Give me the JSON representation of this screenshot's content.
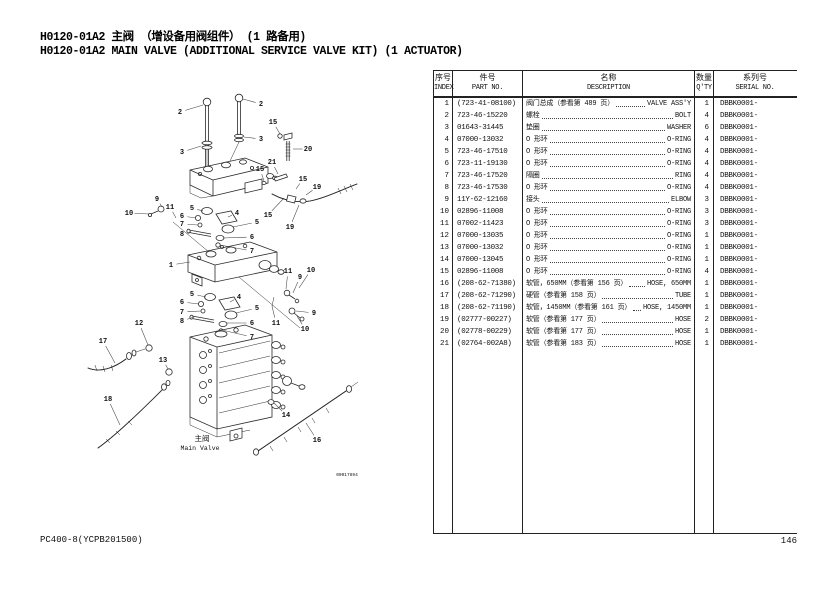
{
  "page": {
    "title_zh": "H0120-01A2 主阀 （增设备用阀组件） (1 路备用)",
    "title_en": "H0120-01A2 MAIN VALVE (ADDITIONAL SERVICE VALVE KIT) (1 ACTUATOR)",
    "footer_left": "PC400-8(YCPB201500)",
    "page_number": "146"
  },
  "diagram": {
    "drawing_number": "00017894",
    "main_valve_label_zh": "主阀",
    "main_valve_label_en": "Main Valve",
    "callouts": [
      {
        "label": "2",
        "x": 140,
        "y": 37,
        "lx": 163,
        "ly": 30
      },
      {
        "label": "2",
        "x": 221,
        "y": 29,
        "lx": 203,
        "ly": 24
      },
      {
        "label": "3",
        "x": 142,
        "y": 77,
        "lx": 161,
        "ly": 71
      },
      {
        "label": "3",
        "x": 221,
        "y": 64,
        "lx": 204,
        "ly": 62
      },
      {
        "label": "15",
        "x": 233,
        "y": 47,
        "lx": 240,
        "ly": 59
      },
      {
        "label": "20",
        "x": 268,
        "y": 74,
        "lx": 253,
        "ly": 74
      },
      {
        "label": "21",
        "x": 232,
        "y": 87,
        "lx": 238,
        "ly": 99
      },
      {
        "label": "15",
        "x": 220,
        "y": 94,
        "lx": 224,
        "ly": 106
      },
      {
        "label": "15",
        "x": 263,
        "y": 104,
        "lx": 256,
        "ly": 114
      },
      {
        "label": "19",
        "x": 277,
        "y": 112,
        "lx": 266,
        "ly": 120
      },
      {
        "label": "15",
        "x": 228,
        "y": 140,
        "lx": 244,
        "ly": 123
      },
      {
        "label": "19",
        "x": 250,
        "y": 152,
        "lx": 259,
        "ly": 130
      },
      {
        "label": "9",
        "x": 117,
        "y": 124,
        "lx": 122,
        "ly": 132
      },
      {
        "label": "10",
        "x": 89,
        "y": 138,
        "lx": 109,
        "ly": 139
      },
      {
        "label": "11",
        "x": 130,
        "y": 132,
        "lx": 136,
        "ly": 143
      },
      {
        "label": "5",
        "x": 152,
        "y": 133,
        "lx": 163,
        "ly": 136
      },
      {
        "label": "6",
        "x": 142,
        "y": 141,
        "lx": 156,
        "ly": 143
      },
      {
        "label": "7",
        "x": 142,
        "y": 149,
        "lx": 158,
        "ly": 150
      },
      {
        "label": "8",
        "x": 142,
        "y": 159,
        "lx": 151,
        "ly": 157
      },
      {
        "label": "4",
        "x": 197,
        "y": 138,
        "lx": 188,
        "ly": 142
      },
      {
        "label": "5",
        "x": 217,
        "y": 147,
        "lx": 193,
        "ly": 152
      },
      {
        "label": "6",
        "x": 212,
        "y": 162,
        "lx": 183,
        "ly": 163
      },
      {
        "label": "7",
        "x": 212,
        "y": 176,
        "lx": 180,
        "ly": 170
      },
      {
        "label": "1",
        "x": 131,
        "y": 190,
        "lx": 150,
        "ly": 187
      },
      {
        "label": "11",
        "x": 248,
        "y": 196,
        "lx": 246,
        "ly": 214
      },
      {
        "label": "9",
        "x": 260,
        "y": 202,
        "lx": 253,
        "ly": 218
      },
      {
        "label": "10",
        "x": 271,
        "y": 195,
        "lx": 259,
        "ly": 213
      },
      {
        "label": "5",
        "x": 152,
        "y": 219,
        "lx": 166,
        "ly": 222
      },
      {
        "label": "6",
        "x": 142,
        "y": 227,
        "lx": 159,
        "ly": 229
      },
      {
        "label": "7",
        "x": 142,
        "y": 237,
        "lx": 161,
        "ly": 236
      },
      {
        "label": "8",
        "x": 142,
        "y": 246,
        "lx": 154,
        "ly": 242
      },
      {
        "label": "4",
        "x": 199,
        "y": 222,
        "lx": 190,
        "ly": 227
      },
      {
        "label": "5",
        "x": 217,
        "y": 233,
        "lx": 196,
        "ly": 238
      },
      {
        "label": "6",
        "x": 212,
        "y": 248,
        "lx": 186,
        "ly": 248
      },
      {
        "label": "7",
        "x": 212,
        "y": 262,
        "lx": 182,
        "ly": 255
      },
      {
        "label": "11",
        "x": 236,
        "y": 248,
        "lx": 232,
        "ly": 231
      },
      {
        "label": "9",
        "x": 274,
        "y": 238,
        "lx": 256,
        "ly": 236
      },
      {
        "label": "10",
        "x": 265,
        "y": 254,
        "lx": 257,
        "ly": 241
      },
      {
        "label": "12",
        "x": 99,
        "y": 248,
        "lx": 108,
        "ly": 270
      },
      {
        "label": "17",
        "x": 63,
        "y": 266,
        "lx": 75,
        "ly": 288
      },
      {
        "label": "13",
        "x": 123,
        "y": 285,
        "lx": 128,
        "ly": 294
      },
      {
        "label": "18",
        "x": 68,
        "y": 324,
        "lx": 80,
        "ly": 350
      },
      {
        "label": "14",
        "x": 246,
        "y": 340,
        "lx": 234,
        "ly": 328
      },
      {
        "label": "16",
        "x": 277,
        "y": 365,
        "lx": 266,
        "ly": 348
      }
    ]
  },
  "table": {
    "headers": [
      {
        "zh": "序号",
        "en": "INDEX"
      },
      {
        "zh": "件号",
        "en": "PART NO."
      },
      {
        "zh": "名称",
        "en": "DESCRIPTION"
      },
      {
        "zh": "数量",
        "en": "Q'TY"
      },
      {
        "zh": "系列号",
        "en": "SERIAL NO."
      }
    ],
    "rows": [
      {
        "index": "1",
        "part_no": "(723-41-08100)",
        "desc_zh": "阀门总成（参看第 489 页）",
        "desc_en": "VALVE ASS'Y",
        "qty": "1",
        "serial": "DBBK0001-"
      },
      {
        "index": "2",
        "part_no": "723-46-15220",
        "desc_zh": "螺栓",
        "desc_en": "BOLT",
        "qty": "4",
        "serial": "DBBK0001-"
      },
      {
        "index": "3",
        "part_no": "01643-31445",
        "desc_zh": "垫圈",
        "desc_en": "WASHER",
        "qty": "6",
        "serial": "DBBK0001-"
      },
      {
        "index": "4",
        "part_no": "07000-13032",
        "desc_zh": "O 形环",
        "desc_en": "O-RING",
        "qty": "4",
        "serial": "DBBK0001-"
      },
      {
        "index": "5",
        "part_no": "723-46-17510",
        "desc_zh": "O 形环",
        "desc_en": "O-RING",
        "qty": "4",
        "serial": "DBBK0001-"
      },
      {
        "index": "6",
        "part_no": "723-11-19130",
        "desc_zh": "O 形环",
        "desc_en": "O-RING",
        "qty": "4",
        "serial": "DBBK0001-"
      },
      {
        "index": "7",
        "part_no": "723-46-17520",
        "desc_zh": "隔圈",
        "desc_en": "RING",
        "qty": "4",
        "serial": "DBBK0001-"
      },
      {
        "index": "8",
        "part_no": "723-46-17530",
        "desc_zh": "O 形环",
        "desc_en": "O-RING",
        "qty": "4",
        "serial": "DBBK0001-"
      },
      {
        "index": "9",
        "part_no": "11Y-62-12160",
        "desc_zh": "接头",
        "desc_en": "ELBOW",
        "qty": "3",
        "serial": "DBBK0001-"
      },
      {
        "index": "10",
        "part_no": "02896-11008",
        "desc_zh": "O 形环",
        "desc_en": "O-RING",
        "qty": "3",
        "serial": "DBBK0001-"
      },
      {
        "index": "11",
        "part_no": "07002-11423",
        "desc_zh": "O 形环",
        "desc_en": "O-RING",
        "qty": "3",
        "serial": "DBBK0001-"
      },
      {
        "index": "12",
        "part_no": "07000-13035",
        "desc_zh": "O 形环",
        "desc_en": "O-RING",
        "qty": "1",
        "serial": "DBBK0001-"
      },
      {
        "index": "13",
        "part_no": "07000-13032",
        "desc_zh": "O 形环",
        "desc_en": "O-RING",
        "qty": "1",
        "serial": "DBBK0001-"
      },
      {
        "index": "14",
        "part_no": "07000-13045",
        "desc_zh": "O 形环",
        "desc_en": "O-RING",
        "qty": "1",
        "serial": "DBBK0001-"
      },
      {
        "index": "15",
        "part_no": "02896-11008",
        "desc_zh": "O 形环",
        "desc_en": "O-RING",
        "qty": "4",
        "serial": "DBBK0001-"
      },
      {
        "index": "16",
        "part_no": "(208-62-71380)",
        "desc_zh": "软管，650MM（参看第 156 页）",
        "desc_en": "HOSE, 650MM",
        "qty": "1",
        "serial": "DBBK0001-"
      },
      {
        "index": "17",
        "part_no": "(208-62-71290)",
        "desc_zh": "硬管（参看第 158 页）",
        "desc_en": "TUBE",
        "qty": "1",
        "serial": "DBBK0001-"
      },
      {
        "index": "18",
        "part_no": "(208-62-71190)",
        "desc_zh": "软管，1450MM（参看第 161 页）",
        "desc_en": "HOSE, 1450MM",
        "qty": "1",
        "serial": "DBBK0001-"
      },
      {
        "index": "19",
        "part_no": "(02777-00227)",
        "desc_zh": "软管（参看第 177 页）",
        "desc_en": "HOSE",
        "qty": "2",
        "serial": "DBBK0001-"
      },
      {
        "index": "20",
        "part_no": "(02778-00229)",
        "desc_zh": "软管（参看第 177 页）",
        "desc_en": "HOSE",
        "qty": "1",
        "serial": "DBBK0001-"
      },
      {
        "index": "21",
        "part_no": "(02764-002A8)",
        "desc_zh": "软管（参看第 183 页）",
        "desc_en": "HOSE",
        "qty": "1",
        "serial": "DBBK0001-"
      }
    ]
  }
}
